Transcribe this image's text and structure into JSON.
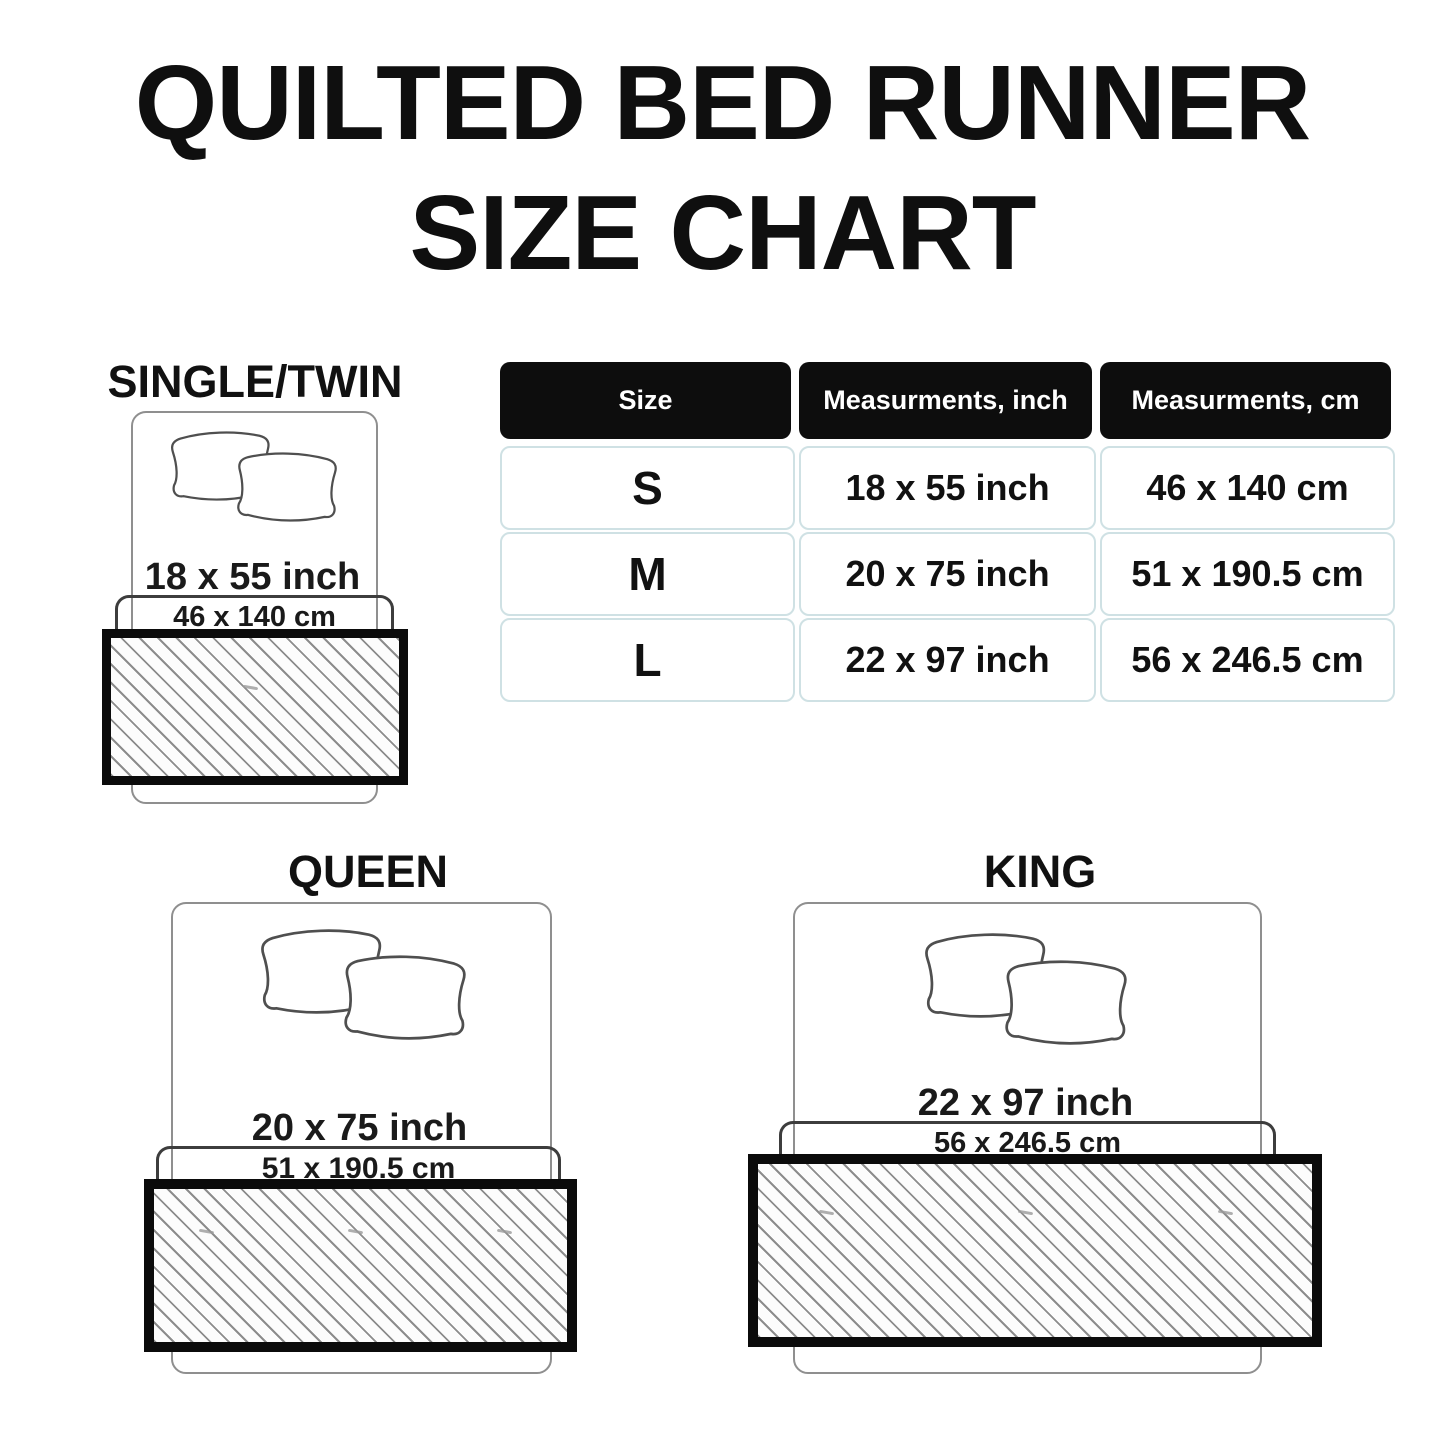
{
  "title": {
    "line1": "QUILTED BED RUNNER",
    "line2": "SIZE CHART"
  },
  "table": {
    "headers": [
      "Size",
      "Measurments, inch",
      "Measurments, cm"
    ],
    "rows": [
      {
        "size": "S",
        "inch": "18 x 55 inch",
        "cm": "46 x 140 cm"
      },
      {
        "size": "M",
        "inch": "20 x 75 inch",
        "cm": "51 x 190.5 cm"
      },
      {
        "size": "L",
        "inch": "22 x 97 inch",
        "cm": "56 x 246.5 cm"
      }
    ]
  },
  "diagrams": [
    {
      "label": "SINGLE/TWIN",
      "inch": "18 x 55 inch",
      "cm": "46 x 140 cm"
    },
    {
      "label": "QUEEN",
      "inch": "20 x 75 inch",
      "cm": "51 x 190.5 cm"
    },
    {
      "label": "KING",
      "inch": "22 x 97 inch",
      "cm": "56 x 246.5 cm"
    }
  ],
  "colors": {
    "background": "#ffffff",
    "text": "#111111",
    "table_header_bg": "#0d0d0d",
    "table_header_text": "#ffffff",
    "table_cell_border": "#cfe1e4",
    "bed_outline": "#8f8f8f",
    "pillow_outline": "#4f4f4f",
    "runner_border": "#0b0b0b",
    "hatch_line": "#8c8c8c"
  }
}
